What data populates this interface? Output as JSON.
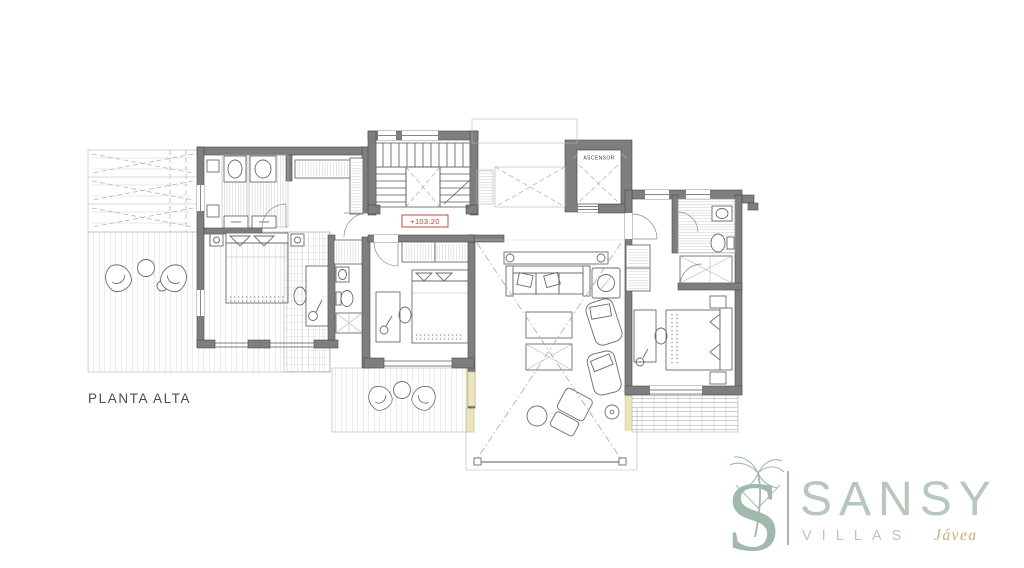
{
  "plan": {
    "title": "PLANTA ALTA",
    "elevator_label": "ASCENSOR",
    "elevation_label": "+103.20"
  },
  "logo": {
    "monogram_letter": "S",
    "brand": "SANSY",
    "villas": "VILLAS",
    "location": "Jávea"
  },
  "icons": {
    "palm_tree": "palm-tree-icon",
    "elevator_void": "elevator-shaft-cross",
    "void_cross": "double-height-void-cross"
  },
  "colors": {
    "background": "#ffffff",
    "wall": "#7e7e7e",
    "wall_edge": "#4a4a4a",
    "drawing_line": "#5a5a5a",
    "light_line": "#b5b5b5",
    "accent_red": "#c0392b",
    "insulation_tan": "#ece4bd",
    "logo_green": "#9fbaab",
    "logo_text_green": "#b6c8bb",
    "logo_gold": "#c4ae7d",
    "plan_text": "#4c4c4c"
  }
}
